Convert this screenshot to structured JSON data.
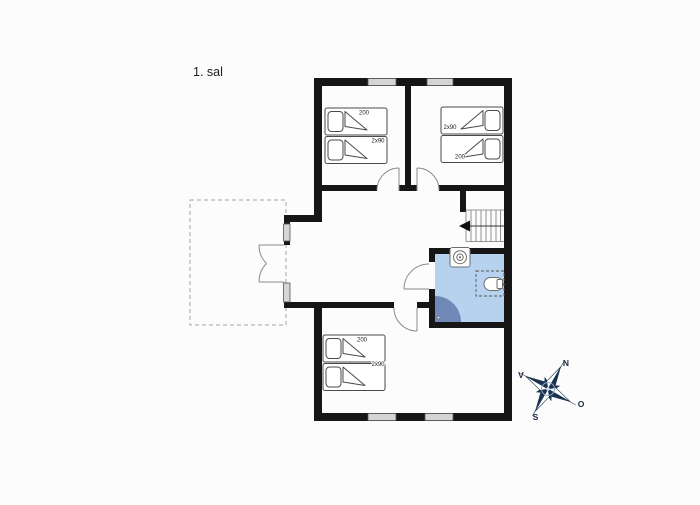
{
  "page": {
    "title": "1. sal"
  },
  "plan": {
    "bedrooms": [
      {
        "name": "bedroom-top-left",
        "bed_length_label": "200",
        "bed_width_label": "2x90"
      },
      {
        "name": "bedroom-top-right",
        "bed_length_label": "200",
        "bed_width_label": "2x90"
      },
      {
        "name": "bedroom-bottom",
        "bed_length_label": "200",
        "bed_width_label": "2x90"
      }
    ],
    "compass": {
      "north": "N",
      "east": "O",
      "south": "S",
      "west": "V"
    },
    "colors": {
      "wall": "#161616",
      "bathroom_floor": "#b6d2ef",
      "bathroom_door_swing": "#7088b5",
      "compass_dark": "#1b3350"
    }
  }
}
